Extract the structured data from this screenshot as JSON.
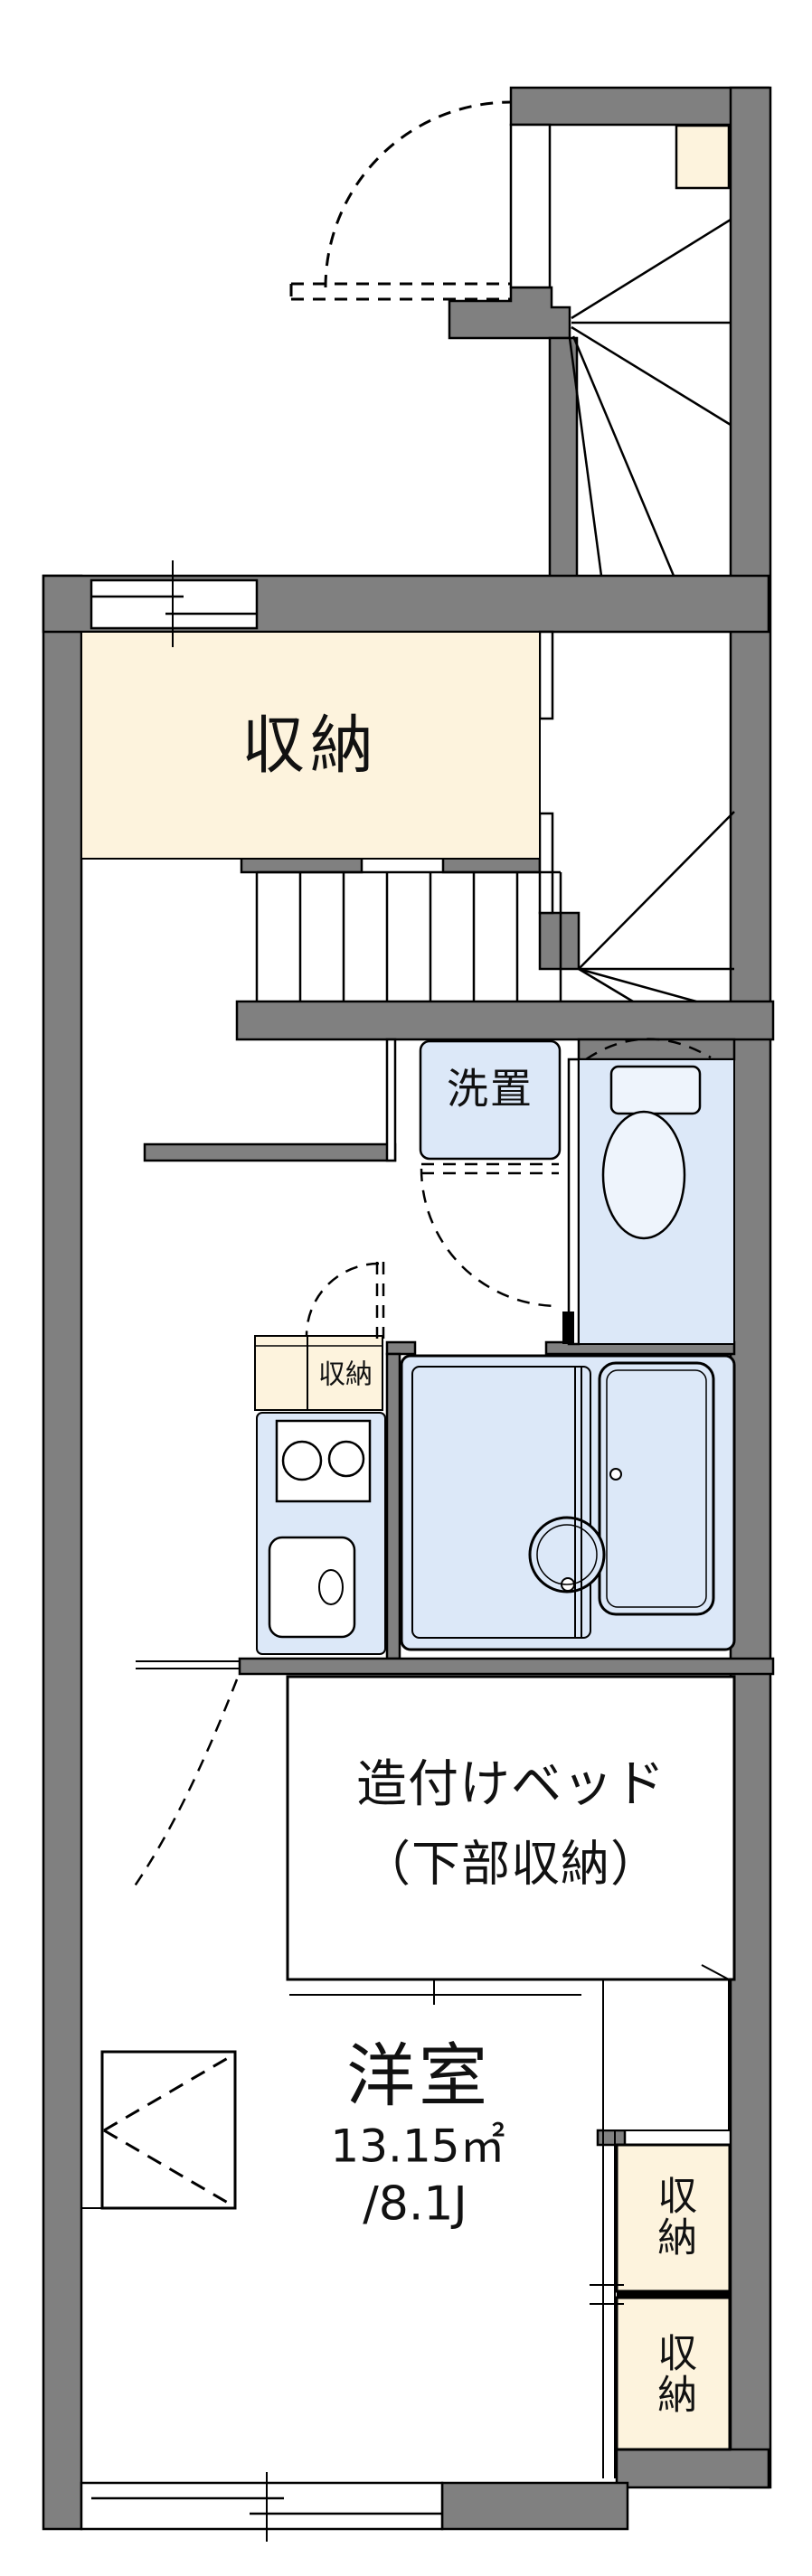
{
  "floorplan": {
    "type": "apartment-floorplan",
    "rooms": {
      "closet_upper": {
        "label": "収納"
      },
      "laundry": {
        "label": "洗置"
      },
      "kitchen_storage": {
        "label": "収納"
      },
      "built_in_bed": {
        "label_line1": "造付けベッド",
        "label_line2": "（下部収納）"
      },
      "main_room": {
        "label": "洋室",
        "area_sqm": "13.15㎡",
        "area_tatami": "/8.1J"
      },
      "storage_right_top": {
        "label": "収納"
      },
      "storage_right_bottom": {
        "label": "収納"
      }
    },
    "colors": {
      "wall": "#808080",
      "storage_fill": "#fdf3dd",
      "fixture_fill": "#dce8f8",
      "fixture_light": "#eef4fc",
      "line": "#000000",
      "background": "#ffffff"
    }
  }
}
